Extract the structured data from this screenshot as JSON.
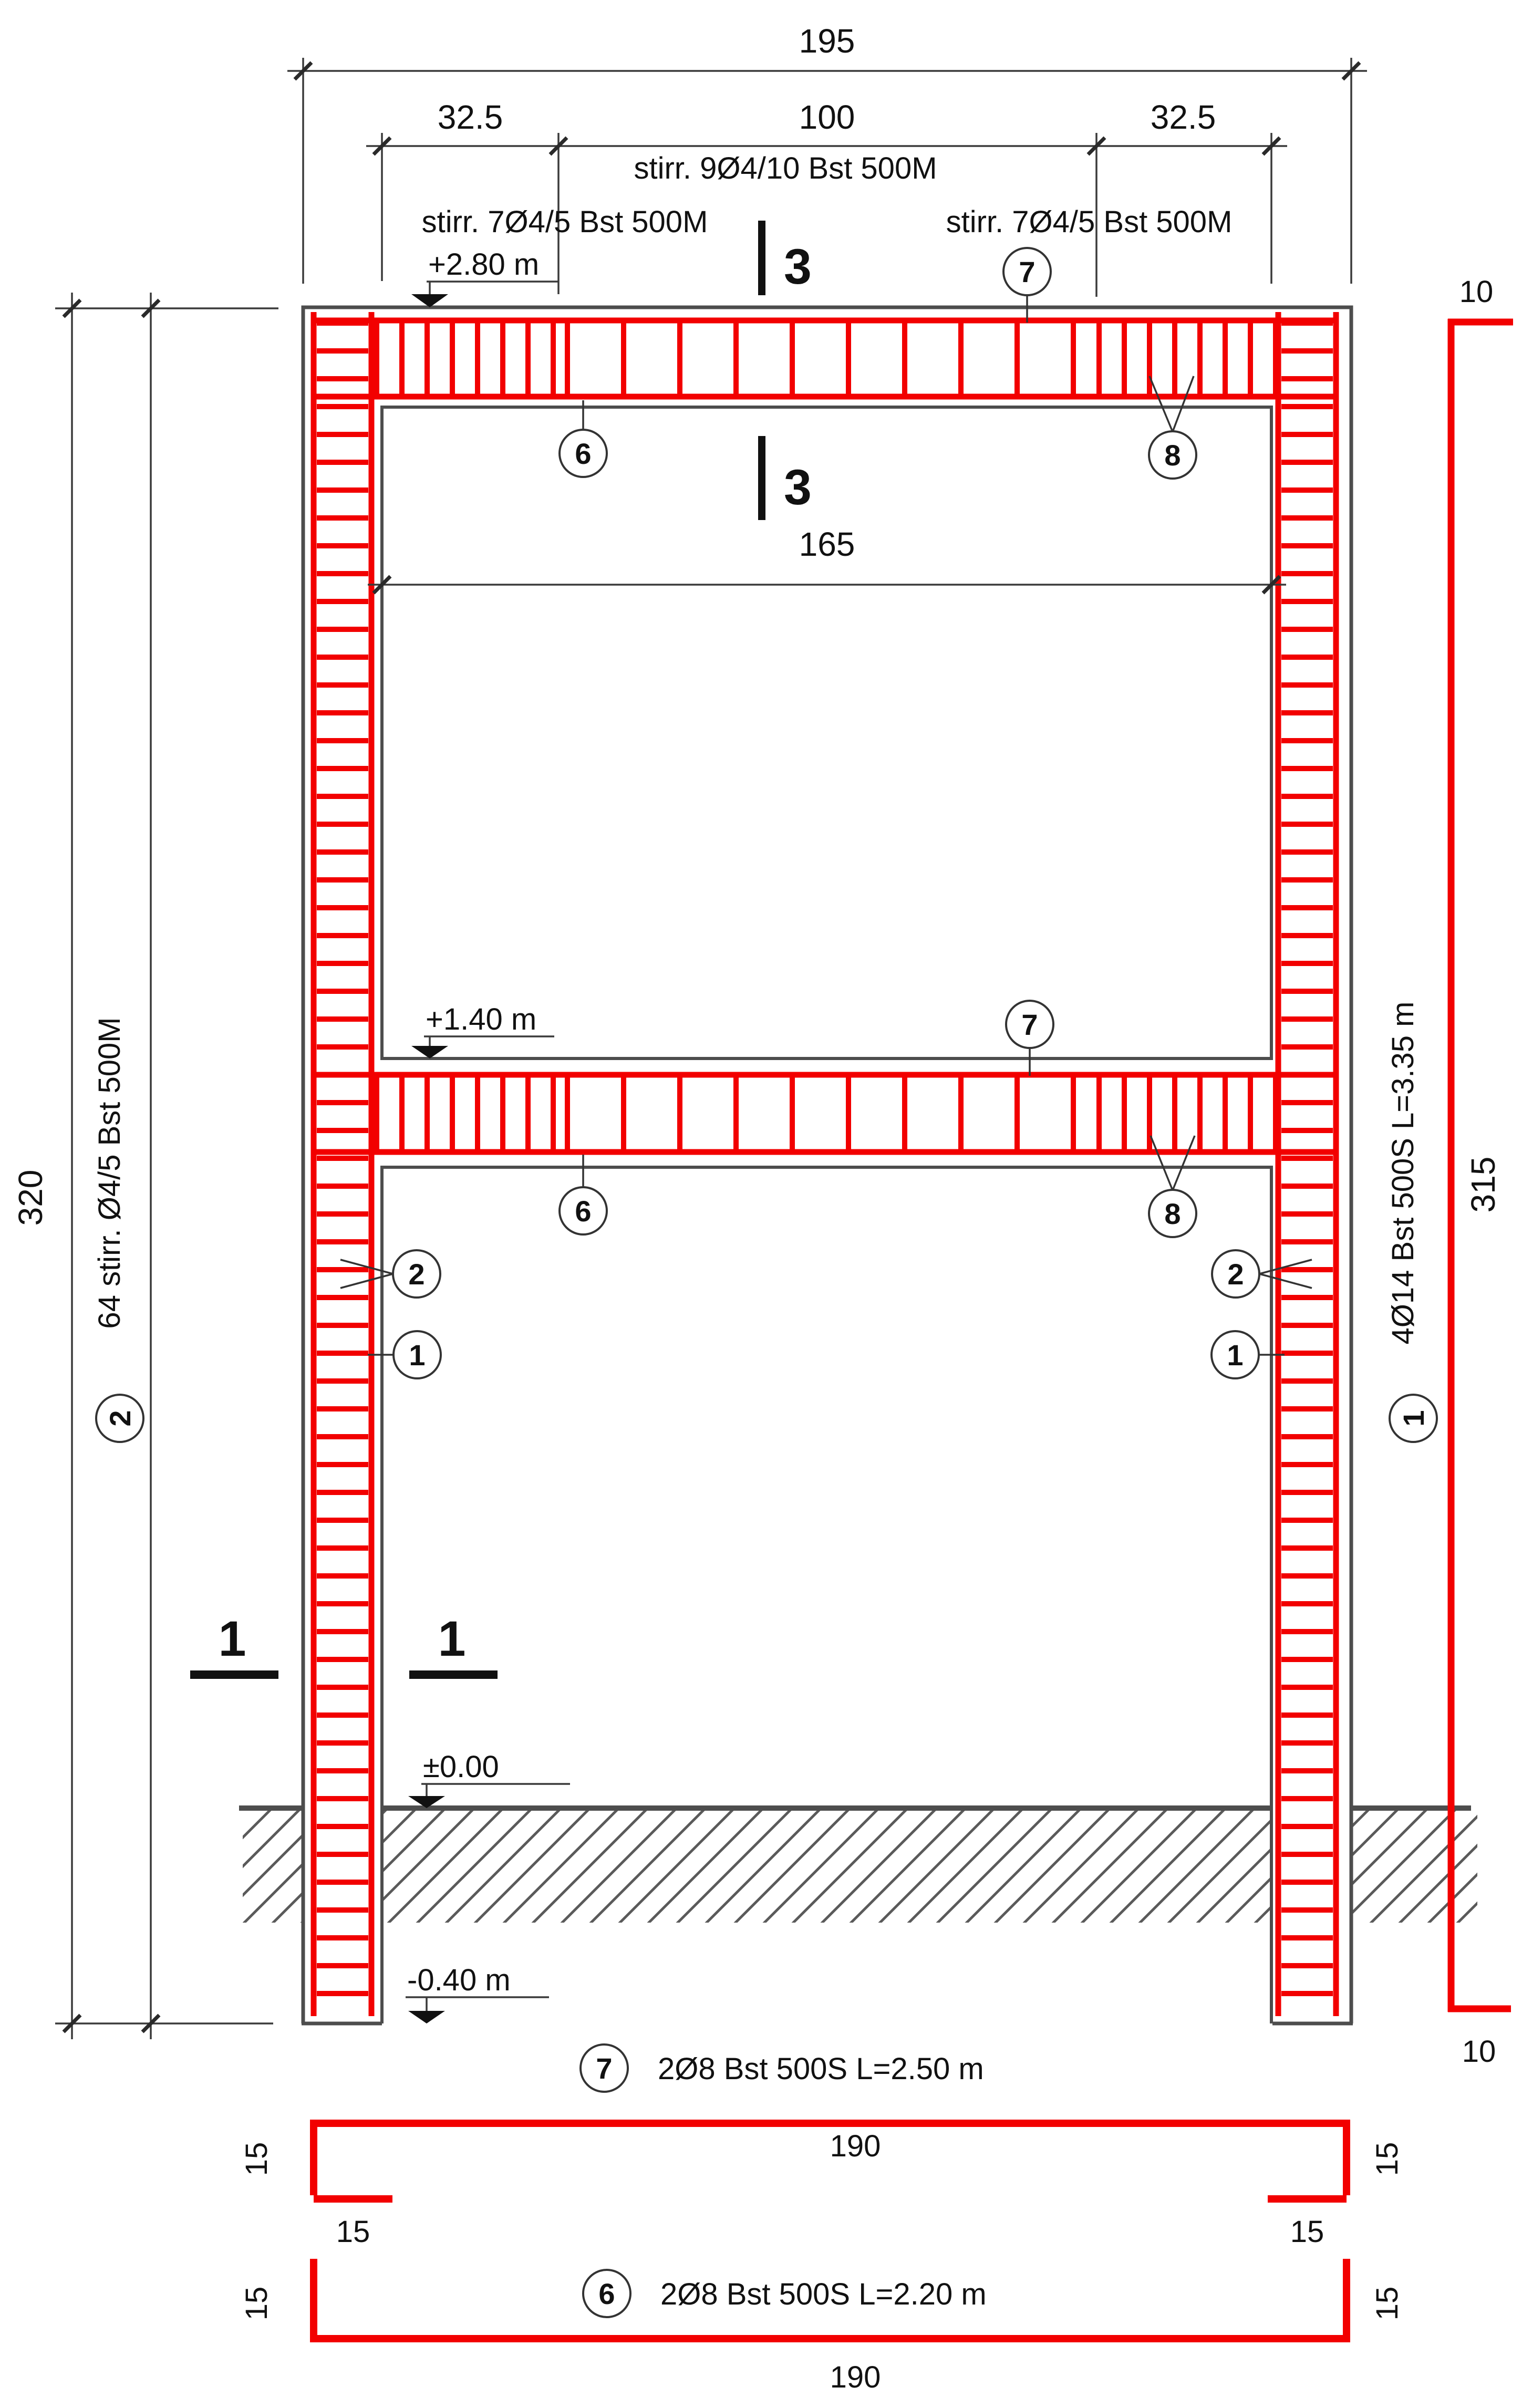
{
  "dims": {
    "overall_width": "195",
    "beam_left": "32.5",
    "beam_mid": "100",
    "beam_right": "32.5",
    "clear_span": "165",
    "overall_height": "320",
    "bar1_length": "315",
    "bar1_hook": "10"
  },
  "levels": {
    "roof": "+2.80 m",
    "floor": "+1.40 m",
    "ground": "±0.00",
    "foundation": "-0.40 m"
  },
  "stirrup_labels": {
    "beam_mid": "stirr. 9Ø4/10 Bst 500M",
    "beam_left": "stirr. 7Ø4/5 Bst 500M",
    "beam_right": "stirr. 7Ø4/5 Bst 500M"
  },
  "side_labels": {
    "left_mark": "2",
    "left_text": "64 stirr. Ø4/5 Bst 500M",
    "right_mark": "1",
    "right_text": "4Ø14 Bst 500S L=3.35 m"
  },
  "sections": {
    "sec3": "3",
    "sec1": "1"
  },
  "callouts": {
    "bar1": "1",
    "stirrup2": "2",
    "bar6": "6",
    "bar7": "7",
    "bar8": "8"
  },
  "details": {
    "bar7": {
      "mark": "7",
      "label": "2Ø8 Bst 500S L=2.50 m",
      "width": "190",
      "leg": "15",
      "hook": "15"
    },
    "bar6": {
      "mark": "6",
      "label": "2Ø8 Bst 500S L=2.20 m",
      "width": "190",
      "leg": "15"
    }
  }
}
